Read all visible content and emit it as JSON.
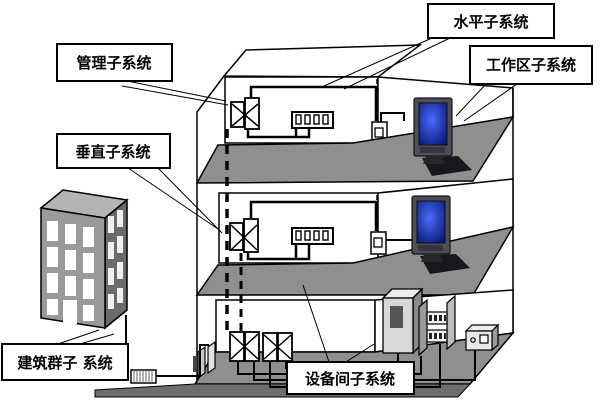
{
  "labels": {
    "horizontal": "水平子系统",
    "management": "管理子系统",
    "workarea": "工作区子系统",
    "vertical": "垂直子系统",
    "campus": "建筑群子 系统",
    "equipment_room": "设备间子系统"
  },
  "colors": {
    "floor": "#8f8f8f",
    "floor_face": "#6e6e6e",
    "building_front": "#9a9a9a",
    "building_side": "#6b6b6b",
    "building_top": "#b4b4b4",
    "screen_center": "#4a6cff",
    "screen_edge": "#0a1a7a",
    "outline": "#000000"
  }
}
